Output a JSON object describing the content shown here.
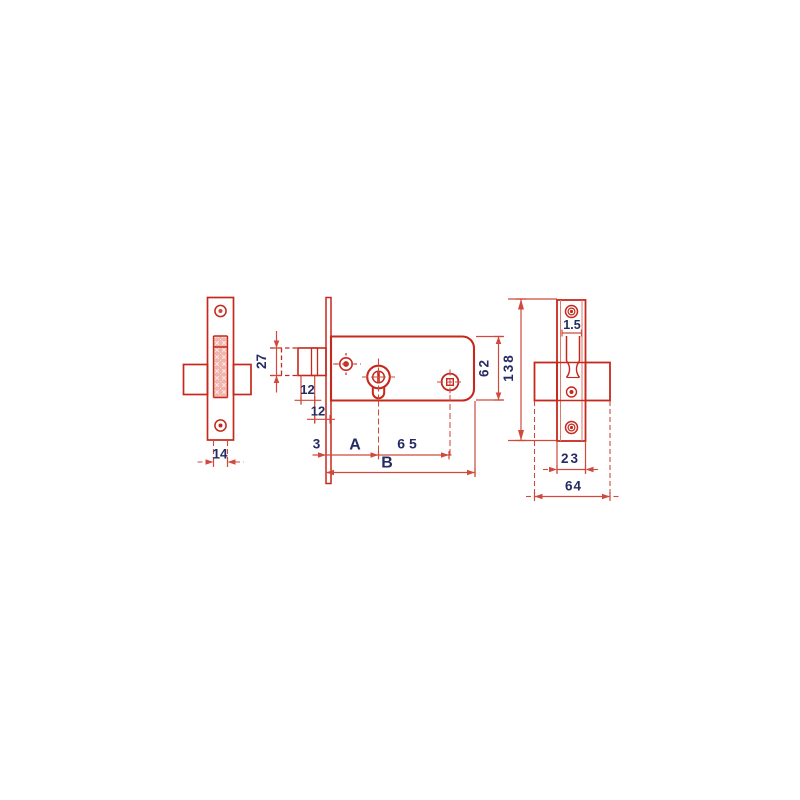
{
  "drawing": {
    "kind": "lock-dimensional-technical-drawing",
    "background": "#ffffff",
    "colors": {
      "part_outline_red": "#c5291d",
      "dimension_red": "#cf4a3c",
      "label_navy": "#242b63",
      "hatch_pink": "#f2b5ae"
    },
    "views": {
      "left_view": {
        "dimension_labels": [
          "14"
        ]
      },
      "middle_view": {
        "dimension_labels": [
          "27",
          "12",
          "12",
          "3",
          "A",
          "65",
          "B",
          "62",
          "138"
        ]
      },
      "right_view": {
        "dimension_labels": [
          "1.5",
          "23",
          "64"
        ]
      }
    },
    "labels": {
      "d14": "14",
      "d27": "27",
      "d12a": "12",
      "d12b": "12",
      "d3": "3",
      "dA": "A",
      "d65": "65",
      "dB": "B",
      "d62": "62",
      "d138": "138",
      "d15": "1.5",
      "d23": "23",
      "d64": "64"
    }
  }
}
